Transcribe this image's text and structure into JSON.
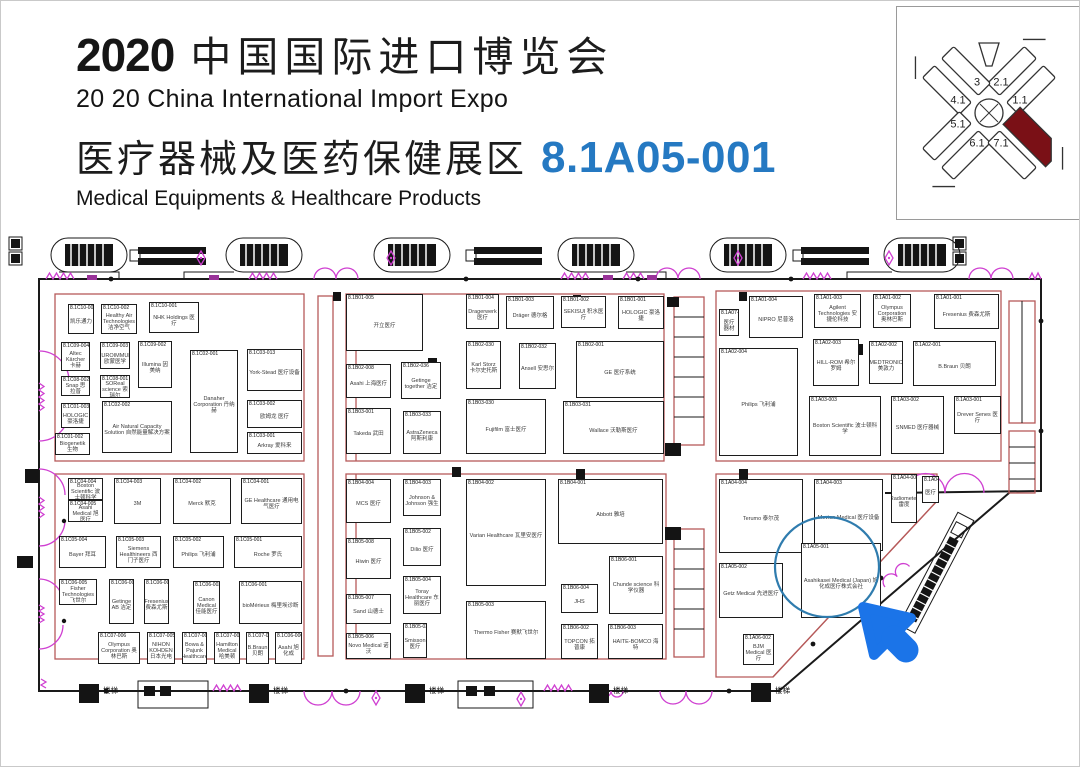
{
  "header": {
    "year": "2020",
    "title_cn": "中国国际进口博览会",
    "title_en": "20 20 China International Import Expo",
    "zone_cn": "医疗器械及医药保健展区",
    "booth_no": "8.1A05-001",
    "zone_en": "Medical Equipments & Healthcare Products"
  },
  "minimap": {
    "halls": [
      {
        "label": "3",
        "x": 80,
        "y": 76
      },
      {
        "label": "2.1",
        "x": 104,
        "y": 76
      },
      {
        "label": "4.1",
        "x": 61,
        "y": 94
      },
      {
        "label": "1.1",
        "x": 123,
        "y": 94
      },
      {
        "label": "5.1",
        "x": 61,
        "y": 118
      },
      {
        "label": "6.1",
        "x": 80,
        "y": 137
      },
      {
        "label": "7.1",
        "x": 104,
        "y": 137
      }
    ],
    "highlighted_hall": "8.1"
  },
  "plan": {
    "highlight": {
      "booth": "8.1A05-001"
    },
    "labels": [
      {
        "text": "楼梯",
        "x": 102,
        "y": 684
      },
      {
        "text": "楼梯",
        "x": 272,
        "y": 684
      },
      {
        "text": "楼梯",
        "x": 428,
        "y": 684
      },
      {
        "text": "楼梯",
        "x": 612,
        "y": 684
      },
      {
        "text": "楼梯",
        "x": 774,
        "y": 684
      }
    ],
    "booths": [
      {
        "id": "8.1C10-003",
        "name": "凯乐通力",
        "x": 67,
        "y": 303,
        "w": 26,
        "h": 30
      },
      {
        "id": "8.1C10-002",
        "name": "Healthy Air Technologies 洁净空气",
        "x": 100,
        "y": 303,
        "w": 36,
        "h": 30
      },
      {
        "id": "8.1C10-001",
        "name": "NHK Holdings 医疗",
        "x": 148,
        "y": 301,
        "w": 50,
        "h": 31
      },
      {
        "id": "8.1C09-004",
        "name": "Altec Kärcher 卡赫",
        "x": 60,
        "y": 341,
        "w": 29,
        "h": 29
      },
      {
        "id": "8.1C09-003",
        "name": "EUROIMMUN 欧蒙医学",
        "x": 99,
        "y": 341,
        "w": 30,
        "h": 27
      },
      {
        "id": "8.1C09-002",
        "name": "Illumina 因美纳",
        "x": 137,
        "y": 340,
        "w": 34,
        "h": 47
      },
      {
        "id": "8.1C08-002",
        "name": "Snap 思拉普",
        "x": 60,
        "y": 375,
        "w": 29,
        "h": 20
      },
      {
        "id": "8.1C08-001",
        "name": "SOReal science 索瑞尔",
        "x": 99,
        "y": 374,
        "w": 30,
        "h": 23
      },
      {
        "id": "8.1C01-003",
        "name": "HOLOGIC 豪洛捷",
        "x": 60,
        "y": 402,
        "w": 29,
        "h": 25
      },
      {
        "id": "8.1C02-002",
        "name": "Air Natural Capacity Solution 自然能量解决方案",
        "x": 101,
        "y": 400,
        "w": 70,
        "h": 52
      },
      {
        "id": "8.1C02-001",
        "name": "Danaher Corporation 丹纳赫",
        "x": 189,
        "y": 349,
        "w": 48,
        "h": 103
      },
      {
        "id": "8.1C01-002",
        "name": "Biogenetik 生物",
        "x": 54,
        "y": 432,
        "w": 35,
        "h": 22
      },
      {
        "id": "8.1C03-013",
        "name": "York-Stead 医疗设备",
        "x": 246,
        "y": 348,
        "w": 55,
        "h": 42
      },
      {
        "id": "8.1C03-002",
        "name": "欧姆龙 医疗",
        "x": 246,
        "y": 399,
        "w": 55,
        "h": 28
      },
      {
        "id": "8.1C03-001",
        "name": "Arkray 爱科来",
        "x": 246,
        "y": 431,
        "w": 55,
        "h": 22
      },
      {
        "id": "8.1B01-005",
        "name": "开立医疗",
        "x": 345,
        "y": 293,
        "w": 77,
        "h": 57
      },
      {
        "id": "8.1B01-004",
        "name": "Dragerwerk 医疗",
        "x": 465,
        "y": 293,
        "w": 33,
        "h": 35
      },
      {
        "id": "8.1B01-003",
        "name": "Dräger 德尔格",
        "x": 505,
        "y": 295,
        "w": 48,
        "h": 33
      },
      {
        "id": "8.1B01-002",
        "name": "SEKISUI 积水医疗",
        "x": 560,
        "y": 295,
        "w": 45,
        "h": 32
      },
      {
        "id": "8.1B01-001",
        "name": "HOLOGIC 豪洛捷",
        "x": 617,
        "y": 295,
        "w": 46,
        "h": 33
      },
      {
        "id": "8.1B02-008",
        "name": "Asahi 上海医疗",
        "x": 345,
        "y": 363,
        "w": 45,
        "h": 34
      },
      {
        "id": "8.1B02-036",
        "name": "Getinge together 洁定",
        "x": 400,
        "y": 361,
        "w": 40,
        "h": 37
      },
      {
        "id": "8.1B02-030",
        "name": "Karl Storz 卡尔史托斯",
        "x": 465,
        "y": 340,
        "w": 35,
        "h": 48
      },
      {
        "id": "8.1B02-032",
        "name": "Ansell 安思尔",
        "x": 518,
        "y": 342,
        "w": 37,
        "h": 46
      },
      {
        "id": "8.1B02-001",
        "name": "GE 医疗系统",
        "x": 575,
        "y": 340,
        "w": 88,
        "h": 57
      },
      {
        "id": "8.1B03-001",
        "name": "Takeda 武田",
        "x": 345,
        "y": 407,
        "w": 45,
        "h": 46
      },
      {
        "id": "8.1B03-033",
        "name": "AstraZeneca 阿斯利康",
        "x": 402,
        "y": 410,
        "w": 38,
        "h": 43
      },
      {
        "id": "8.1B03-030",
        "name": "Fujifilm 富士医疗",
        "x": 465,
        "y": 398,
        "w": 80,
        "h": 55
      },
      {
        "id": "8.1B03-031",
        "name": "Wallace 沃勒斯医疗",
        "x": 562,
        "y": 400,
        "w": 101,
        "h": 53
      },
      {
        "id": "8.1A07-001",
        "name": "医疗器材",
        "x": 718,
        "y": 308,
        "w": 20,
        "h": 27
      },
      {
        "id": "8.1A01-004",
        "name": "NIPRO 尼普洛",
        "x": 748,
        "y": 295,
        "w": 54,
        "h": 42
      },
      {
        "id": "8.1A01-003",
        "name": "Agilent Technologies 安捷伦科技",
        "x": 813,
        "y": 293,
        "w": 47,
        "h": 34
      },
      {
        "id": "8.1A01-002",
        "name": "Olympus Corporation 奥林巴斯",
        "x": 872,
        "y": 293,
        "w": 38,
        "h": 34
      },
      {
        "id": "8.1A01-001",
        "name": "Fresenius 费森尤斯",
        "x": 933,
        "y": 293,
        "w": 65,
        "h": 35
      },
      {
        "id": "8.1A02-004",
        "name": "Philips 飞利浦",
        "x": 718,
        "y": 347,
        "w": 79,
        "h": 108
      },
      {
        "id": "8.1A02-003",
        "name": "HILL-ROM 希尔罗姆",
        "x": 812,
        "y": 338,
        "w": 46,
        "h": 47
      },
      {
        "id": "8.1A02-002",
        "name": "MEDTRONIC 美敦力",
        "x": 868,
        "y": 340,
        "w": 34,
        "h": 43
      },
      {
        "id": "8.1A02-001",
        "name": "B.Braun 贝朗",
        "x": 912,
        "y": 340,
        "w": 83,
        "h": 45
      },
      {
        "id": "8.1A03-003",
        "name": "Boston Scientific 波士顿科学",
        "x": 808,
        "y": 395,
        "w": 72,
        "h": 60
      },
      {
        "id": "8.1A03-002",
        "name": "SNMED 医疗器械",
        "x": 890,
        "y": 395,
        "w": 53,
        "h": 58
      },
      {
        "id": "8.1A03-001",
        "name": "Drever Senes 医疗",
        "x": 953,
        "y": 395,
        "w": 47,
        "h": 38
      },
      {
        "id": "8.1A04-004",
        "name": "Terumo 泰尔茂",
        "x": 718,
        "y": 478,
        "w": 84,
        "h": 74
      },
      {
        "id": "8.1A04-003",
        "name": "Mevion Medical 医疗设备",
        "x": 813,
        "y": 478,
        "w": 69,
        "h": 72
      },
      {
        "id": "8.1A04-002",
        "name": "Radiometer 雷度",
        "x": 890,
        "y": 473,
        "w": 26,
        "h": 49
      },
      {
        "id": "8.1A04-001",
        "name": "医疗",
        "x": 921,
        "y": 475,
        "w": 17,
        "h": 27
      },
      {
        "id": "8.1A05-002",
        "name": "Getz Medical 先进医疗",
        "x": 718,
        "y": 562,
        "w": 64,
        "h": 55
      },
      {
        "id": "8.1A05-001",
        "name": "Asahikasei Medical (Japan) 旭化成医疗株式会社",
        "x": 800,
        "y": 542,
        "w": 80,
        "h": 75
      },
      {
        "id": "8.1A06-002",
        "name": "BJM Medical 医疗",
        "x": 742,
        "y": 633,
        "w": 31,
        "h": 31
      },
      {
        "id": "8.1C04-004",
        "name": "Boston Scientific 波士顿科学",
        "x": 67,
        "y": 477,
        "w": 35,
        "h": 22
      },
      {
        "id": "8.1C04-005",
        "name": "Asahi Medical 旭医疗",
        "x": 67,
        "y": 499,
        "w": 35,
        "h": 22
      },
      {
        "id": "8.1C04-003",
        "name": "3M",
        "x": 113,
        "y": 477,
        "w": 47,
        "h": 46
      },
      {
        "id": "8.1C04-002",
        "name": "Merck 默克",
        "x": 172,
        "y": 477,
        "w": 58,
        "h": 46
      },
      {
        "id": "8.1C04-001",
        "name": "GE Healthcare 通用电气医疗",
        "x": 240,
        "y": 477,
        "w": 61,
        "h": 46
      },
      {
        "id": "8.1C05-004",
        "name": "Bayer 拜耳",
        "x": 58,
        "y": 535,
        "w": 47,
        "h": 32
      },
      {
        "id": "8.1C05-003",
        "name": "Siemens Healthineers 西门子医疗",
        "x": 115,
        "y": 535,
        "w": 45,
        "h": 32
      },
      {
        "id": "8.1C05-002",
        "name": "Philips 飞利浦",
        "x": 172,
        "y": 535,
        "w": 51,
        "h": 32
      },
      {
        "id": "8.1C05-001",
        "name": "Roche 罗氏",
        "x": 233,
        "y": 535,
        "w": 68,
        "h": 32
      },
      {
        "id": "8.1C06-005",
        "name": "Fisher Technologies 飞世尔",
        "x": 58,
        "y": 578,
        "w": 38,
        "h": 26
      },
      {
        "id": "8.1C06-004",
        "name": "Getinge AB 洁定",
        "x": 108,
        "y": 578,
        "w": 25,
        "h": 45
      },
      {
        "id": "8.1C06-003",
        "name": "Fresenius 费森尤斯",
        "x": 143,
        "y": 578,
        "w": 25,
        "h": 45
      },
      {
        "id": "8.1C06-002",
        "name": "Canon Medical 佳能医疗",
        "x": 192,
        "y": 580,
        "w": 27,
        "h": 43
      },
      {
        "id": "8.1C06-001",
        "name": "bioMérieux 梅里埃诊断",
        "x": 238,
        "y": 580,
        "w": 63,
        "h": 43
      },
      {
        "id": "8.1C07-006",
        "name": "Olympus Corporation 奥林巴斯",
        "x": 97,
        "y": 631,
        "w": 42,
        "h": 32
      },
      {
        "id": "8.1C07-005",
        "name": "NIHON KOHDEN 日本光电",
        "x": 146,
        "y": 631,
        "w": 28,
        "h": 32
      },
      {
        "id": "8.1C07-003",
        "name": "Bowa & Pajunk Healthcare",
        "x": 181,
        "y": 631,
        "w": 25,
        "h": 32
      },
      {
        "id": "8.1C07-002",
        "name": "Hamilton Medical 哈美顿",
        "x": 213,
        "y": 631,
        "w": 26,
        "h": 32
      },
      {
        "id": "8.1C07-001",
        "name": "B.Braun 贝朗",
        "x": 245,
        "y": 631,
        "w": 23,
        "h": 32
      },
      {
        "id": "8.1C06-006",
        "name": "Asahi 旭化成",
        "x": 274,
        "y": 631,
        "w": 27,
        "h": 32
      },
      {
        "id": "8.1B04-004",
        "name": "MCS 医疗",
        "x": 345,
        "y": 478,
        "w": 45,
        "h": 44
      },
      {
        "id": "8.1B05-008",
        "name": "Hiwin 医疗",
        "x": 345,
        "y": 537,
        "w": 45,
        "h": 41
      },
      {
        "id": "8.1B05-007",
        "name": "Sand 山德士",
        "x": 345,
        "y": 593,
        "w": 45,
        "h": 30
      },
      {
        "id": "8.1B05-006",
        "name": "Novo Medical 诺沃",
        "x": 345,
        "y": 632,
        "w": 45,
        "h": 26
      },
      {
        "id": "8.1B04-003",
        "name": "Johnson & Johnson 强生",
        "x": 402,
        "y": 478,
        "w": 38,
        "h": 37
      },
      {
        "id": "8.1B05-002",
        "name": "Dilio 医疗",
        "x": 402,
        "y": 527,
        "w": 38,
        "h": 38
      },
      {
        "id": "8.1B05-004",
        "name": "Toray Healthcare 东丽医疗",
        "x": 402,
        "y": 575,
        "w": 38,
        "h": 38
      },
      {
        "id": "8.1B05-034",
        "name": "Smisson 医疗",
        "x": 402,
        "y": 622,
        "w": 24,
        "h": 35
      },
      {
        "id": "8.1B04-002",
        "name": "Varian Healthcare 瓦里安医疗",
        "x": 465,
        "y": 478,
        "w": 80,
        "h": 107
      },
      {
        "id": "8.1B05-003",
        "name": "Thermo Fisher 赛默飞世尔",
        "x": 465,
        "y": 600,
        "w": 80,
        "h": 58
      },
      {
        "id": "8.1B04-001",
        "name": "Abbott 雅培",
        "x": 557,
        "y": 478,
        "w": 105,
        "h": 65
      },
      {
        "id": "8.1B06-004",
        "name": "JHS",
        "x": 560,
        "y": 583,
        "w": 37,
        "h": 29
      },
      {
        "id": "8.1B06-001",
        "name": "Chunde science 科学仪器",
        "x": 608,
        "y": 555,
        "w": 54,
        "h": 58
      },
      {
        "id": "8.1B06-002",
        "name": "TOPCON 拓普康",
        "x": 560,
        "y": 623,
        "w": 37,
        "h": 35
      },
      {
        "id": "8.1B06-003",
        "name": "HAITE-BOMCO 海特",
        "x": 607,
        "y": 623,
        "w": 55,
        "h": 35
      }
    ]
  },
  "colors": {
    "accent-blue": "#2579c2",
    "arrow-blue": "#1b74e8",
    "circle-blue": "#2f7cae",
    "door-magenta": "#cf3fd1",
    "block-red": "#b65a5a",
    "hall-red": "#7a1016"
  }
}
